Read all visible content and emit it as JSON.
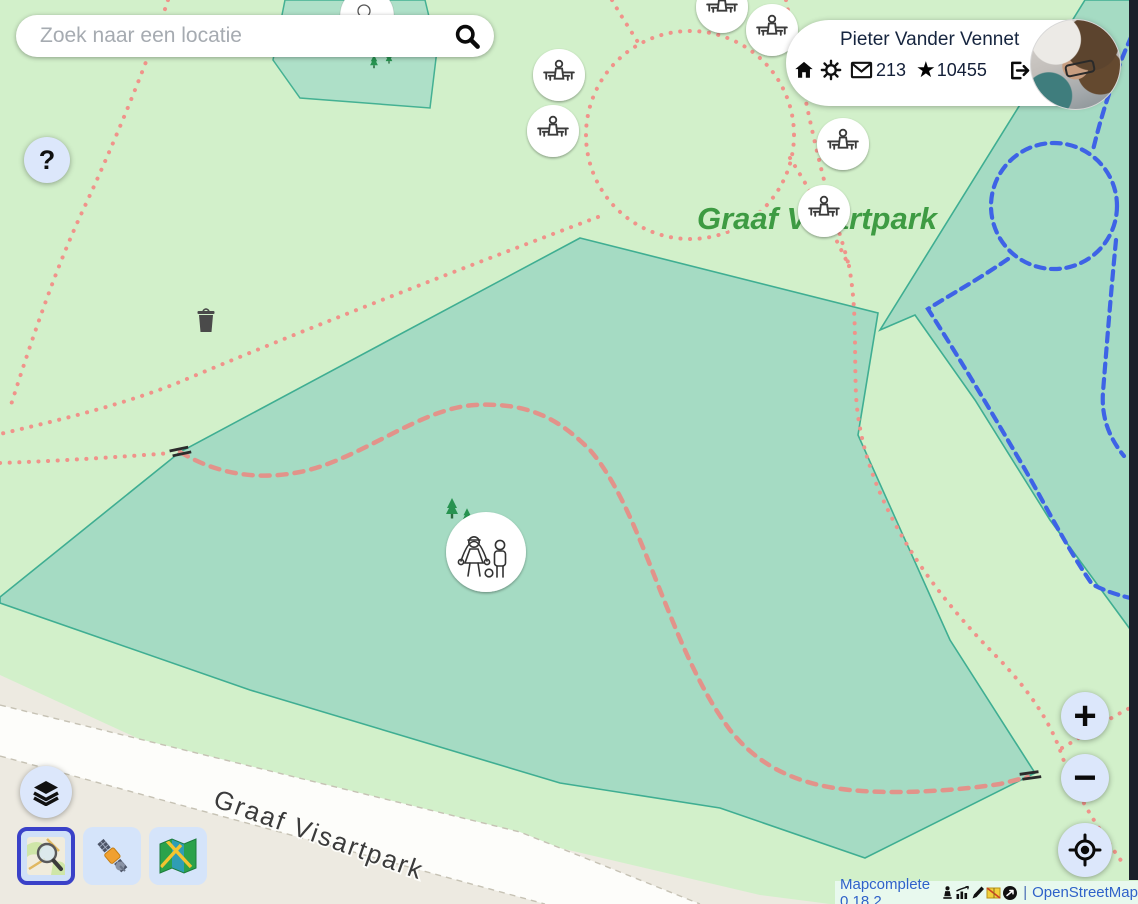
{
  "search": {
    "placeholder": "Zoek naar een locatie"
  },
  "user": {
    "name": "Pieter Vander Vennet",
    "messages_count": "213",
    "stars_count": "10455"
  },
  "help_button": {
    "label": "?"
  },
  "map_labels": {
    "park": "Graaf Visartpark",
    "street": "Graaf Visartpark"
  },
  "controls": {
    "zoom_in": "+",
    "zoom_out": "−"
  },
  "attribution": {
    "app_version": "Mapcomplete 0.18.2",
    "separator": "|",
    "osm_link": "OpenStreetMap"
  },
  "icons": {
    "search": "magnifier",
    "help": "question-mark",
    "home": "house",
    "settings": "gear",
    "messages": "envelope",
    "changesets": "star",
    "logout": "exit-arrow",
    "layers": "stacked-layers",
    "geolocate": "crosshair",
    "basemaps": [
      "osm-carto-preview",
      "satellite-imagery",
      "folded-map"
    ],
    "selected_basemap": "osm-carto-preview",
    "markers": {
      "picnic_table": "person-at-picnic-table",
      "playground": "children-playing",
      "waste_basket": "waste-basket",
      "gate": "gate"
    }
  },
  "colors": {
    "park_green_light": "#d2f0ca",
    "grass_teal": "#a5dbc3",
    "teal_border": "#3fae92",
    "path_red": "#f0938a",
    "path_blue": "#3e63e6",
    "road_beige": "#edeae1",
    "label_green": "#3e9b43",
    "accent_selected": "#3a41c8",
    "button_bg": "#dce7fb",
    "link_blue": "#2f62c9",
    "navy_text": "#16253f",
    "dark_strip": "#1b202b"
  }
}
